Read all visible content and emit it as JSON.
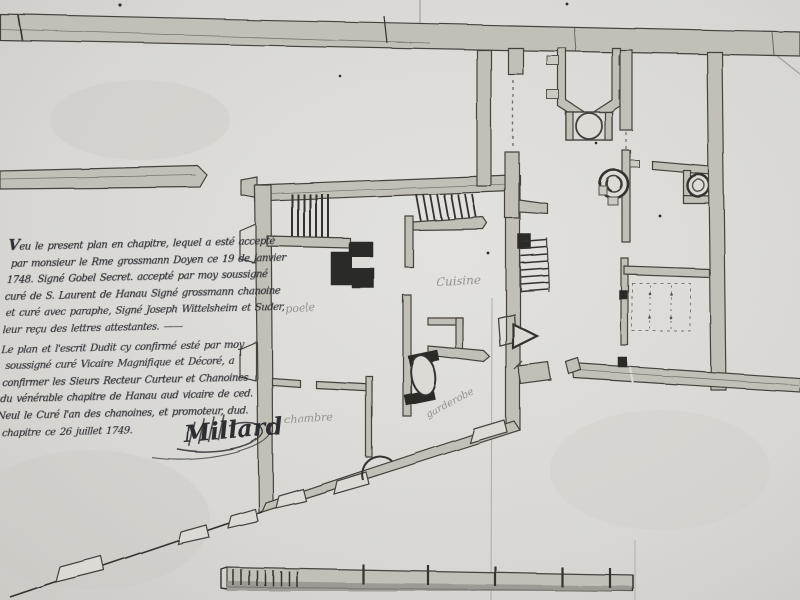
{
  "document_kind": "hand-drawn architectural floor plan manuscript, photographed in black and white",
  "colors": {
    "paper": "#d8d7d3",
    "paper_light": "#e4e3df",
    "ink": "#45433e",
    "dark_ink_fill": "#2b2a27",
    "wall_wash": "#c2bfb6",
    "pencil_gray": "#94918b"
  },
  "rooms": {
    "poele": "poele",
    "cuisine": "Cuisine",
    "chambre": "chambre",
    "garderobe": "garderobe"
  },
  "manuscript": {
    "lines": [
      "Veu le present plan en chapitre, lequel a esté accepté",
      "par monsieur le Rme grossmann Doyen ce 19 de janvier",
      "1748. Signé Gobel Secret. accepté par moy soussigné",
      "curé de S. Laurent de Hanau Signé grossmann chanoine",
      "et curé avec paraphe, Signé Joseph Wittelsheim et Suder,",
      "leur reçu des lettres attestantes. ——",
      "Le plan et l'escrit Dudit cy confirmé esté par moy",
      "soussigné curé Vicaire Magnifique et Décoré, a",
      "confirmer les Sieurs Recteur Curteur et Chanoines",
      "du vénérable chapitre de Hanau aud vicaire de ced.",
      "Neul le Curé l'an des chanoines, et promoteur, dud.",
      "chapitre ce 26 juillet 1749."
    ],
    "signature": "Millard",
    "date_visible": "26 juillet 1749"
  }
}
